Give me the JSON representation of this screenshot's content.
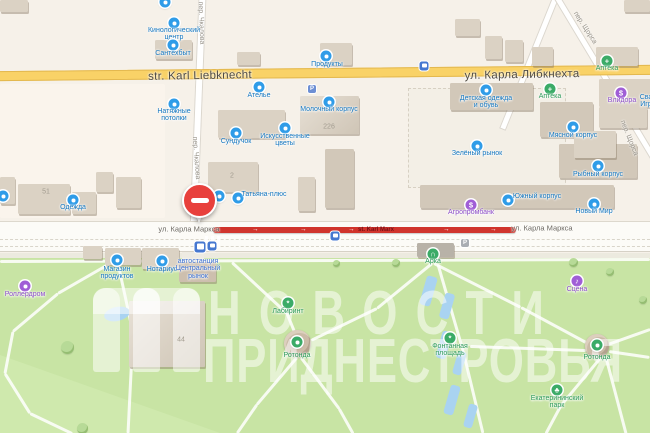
{
  "watermark": {
    "line1": "НОВОСТИ",
    "line2": "ПРИДНЕСТРОВЬЯ"
  },
  "colors": {
    "poi_blue": "#2f9ce8",
    "poi_green": "#3bab67",
    "poi_purple": "#a05ed6",
    "text_blue": "#1477c0",
    "text_green": "#2b9a58",
    "text_purple": "#8d4ec9",
    "text_transit": "#3b6fd1",
    "road_closed": "#d0342c",
    "road_yellow": "#f9d267",
    "park": "#c8e4a4",
    "water": "#a9d3f1"
  },
  "map": {
    "closure": {
      "x1": 213,
      "x2": 516,
      "y_top": 227,
      "label": "st. Karl Marx",
      "label_x": 376,
      "label_y": 230,
      "arrow_glyph": "→",
      "arrows": [
        252,
        300,
        348,
        443,
        490
      ]
    },
    "pin": {
      "x": 199,
      "y": 200,
      "icon": "no-entry-icon"
    },
    "street_labels": [
      {
        "id": "street-karl-liebknecht-en",
        "text": "str. Karl Liebknecht",
        "x": 200,
        "y": 76,
        "rot": -1,
        "cls": "major"
      },
      {
        "id": "street-karla-libknehta-ru",
        "text": "ул. Карла Либкнехта",
        "x": 522,
        "y": 75,
        "rot": -1,
        "cls": "major"
      },
      {
        "id": "street-karla-marksa-left",
        "text": "ул. Карла Маркса",
        "x": 189,
        "y": 229,
        "rot": 0,
        "cls": "minor"
      },
      {
        "id": "street-karla-marksa-right",
        "text": "ул. Карла Маркса",
        "x": 542,
        "y": 228,
        "rot": 0,
        "cls": "minor"
      },
      {
        "id": "street-chkalova-top",
        "text": "пер. Чкалова",
        "x": 201,
        "y": 23,
        "rot": 88,
        "cls": "lane"
      },
      {
        "id": "street-chkalova-mid",
        "text": "пер. Чкалова",
        "x": 196,
        "y": 158,
        "rot": 86,
        "cls": "lane"
      },
      {
        "id": "street-schorsa-top",
        "text": "пер. Щорса",
        "x": 585,
        "y": 28,
        "rot": 57,
        "cls": "lane"
      },
      {
        "id": "street-schorsa-mid",
        "text": "пер. Щорса",
        "x": 629,
        "y": 138,
        "rot": 68,
        "cls": "lane"
      }
    ],
    "numbers": [
      {
        "text": "51",
        "x": 46,
        "y": 192
      },
      {
        "text": "2",
        "x": 232,
        "y": 176
      },
      {
        "text": "226",
        "x": 329,
        "y": 127
      },
      {
        "text": "44",
        "x": 181,
        "y": 340
      }
    ],
    "pois": [
      {
        "id": "poi-kinologichesky-centr",
        "icon": "paw-icon",
        "x": 174,
        "y": 23,
        "c": "blue",
        "glyph": "dot",
        "label": [
          "Кинологический",
          "центр"
        ],
        "lx": 174,
        "ly": 31
      },
      {
        "id": "poi-santehbyt",
        "icon": "shop-icon",
        "x": 173,
        "y": 45,
        "c": "blue",
        "glyph": "dot",
        "label": [
          "Сантехбыт"
        ],
        "lx": 173,
        "ly": 54
      },
      {
        "id": "poi-produkty",
        "icon": "shop-icon",
        "x": 326,
        "y": 56,
        "c": "blue",
        "glyph": "dot",
        "label": [
          "Продукты"
        ],
        "lx": 327,
        "ly": 65
      },
      {
        "id": "poi-atelye",
        "icon": "scissors-icon",
        "x": 259,
        "y": 87,
        "c": "blue",
        "glyph": "dot",
        "label": [
          "Ателье"
        ],
        "lx": 259,
        "ly": 96
      },
      {
        "id": "poi-natyazhnye-potolki",
        "icon": "shop-icon",
        "x": 174,
        "y": 104,
        "c": "blue",
        "glyph": "dot",
        "label": [
          "Натяжные",
          "потолки"
        ],
        "lx": 174,
        "ly": 112
      },
      {
        "id": "poi-molochny-korpus",
        "icon": "market-icon",
        "x": 329,
        "y": 102,
        "c": "blue",
        "glyph": "dot",
        "label": [
          "Молочный корпус"
        ],
        "lx": 329,
        "ly": 110
      },
      {
        "id": "poi-iskusstvennye-tsvety",
        "icon": "flower-icon",
        "x": 285,
        "y": 128,
        "c": "blue",
        "glyph": "dot",
        "label": [
          "Искусственные",
          "цветы"
        ],
        "lx": 285,
        "ly": 137
      },
      {
        "id": "poi-sunduchok",
        "icon": "shop-icon",
        "x": 236,
        "y": 133,
        "c": "blue",
        "glyph": "dot",
        "label": [
          "Сундучок"
        ],
        "lx": 236,
        "ly": 142
      },
      {
        "id": "poi-tatyana-plus",
        "icon": "shop-icon",
        "x": 238,
        "y": 198,
        "c": "blue",
        "glyph": "dot",
        "label": [
          "Татьяна-плюс"
        ],
        "lx": 264,
        "ly": 195
      },
      {
        "id": "poi-shop-near-pin",
        "icon": "shop-icon",
        "x": 219,
        "y": 196,
        "c": "blue",
        "glyph": "dot",
        "label": [],
        "lx": 0,
        "ly": 0
      },
      {
        "id": "poi-odezhda",
        "icon": "clothes-icon",
        "x": 73,
        "y": 200,
        "c": "blue",
        "glyph": "dot",
        "label": [
          "Одежда"
        ],
        "lx": 73,
        "ly": 208
      },
      {
        "id": "poi-left-edge-shop",
        "icon": "shop-icon",
        "x": 3,
        "y": 196,
        "c": "blue",
        "glyph": "dot",
        "label": [],
        "lx": 0,
        "ly": 0
      },
      {
        "id": "poi-top-edge-shop",
        "icon": "shop-icon",
        "x": 165,
        "y": 2,
        "c": "blue",
        "glyph": "dot",
        "label": [],
        "lx": 0,
        "ly": 0
      },
      {
        "id": "poi-detskaya-odezhda",
        "icon": "clothes-icon",
        "x": 486,
        "y": 90,
        "c": "blue",
        "glyph": "dot",
        "label": [
          "Детская одежда",
          "и обувь"
        ],
        "lx": 486,
        "ly": 99
      },
      {
        "id": "poi-apteka-north",
        "icon": "pharmacy-cross-icon",
        "x": 607,
        "y": 61,
        "c": "green",
        "glyph": "+",
        "label": [
          "Аптека"
        ],
        "lx": 607,
        "ly": 69
      },
      {
        "id": "poi-apteka-south",
        "icon": "pharmacy-cross-icon",
        "x": 550,
        "y": 89,
        "c": "green",
        "glyph": "+",
        "label": [
          "Аптека"
        ],
        "lx": 550,
        "ly": 97
      },
      {
        "id": "poi-vlidora",
        "icon": "currency-icon",
        "x": 621,
        "y": 93,
        "c": "purple",
        "glyph": "$",
        "label": [
          "Влидора"
        ],
        "lx": 622,
        "ly": 101
      },
      {
        "id": "poi-edge-partial-label",
        "icon": "",
        "x": 0,
        "y": 0,
        "c": "blue",
        "glyph": "",
        "label": [
          "Сва",
          "Игр"
        ],
        "lx": 646,
        "ly": 98
      },
      {
        "id": "poi-zelyony-rynok",
        "icon": "market-icon",
        "x": 477,
        "y": 146,
        "c": "blue",
        "glyph": "dot",
        "label": [
          "Зелёный рынок"
        ],
        "lx": 477,
        "ly": 154
      },
      {
        "id": "poi-myasnoy-korpus",
        "icon": "market-icon",
        "x": 573,
        "y": 127,
        "c": "blue",
        "glyph": "dot",
        "label": [
          "Мясной корпус"
        ],
        "lx": 573,
        "ly": 136
      },
      {
        "id": "poi-rybny-korpus",
        "icon": "market-icon",
        "x": 598,
        "y": 166,
        "c": "blue",
        "glyph": "dot",
        "label": [
          "Рыбный корпус"
        ],
        "lx": 598,
        "ly": 175
      },
      {
        "id": "poi-yuzhny-korpus",
        "icon": "market-icon",
        "x": 508,
        "y": 200,
        "c": "blue",
        "glyph": "dot",
        "label": [
          "Южный корпус"
        ],
        "lx": 537,
        "ly": 197
      },
      {
        "id": "poi-agroprombank",
        "icon": "bank-icon",
        "x": 471,
        "y": 205,
        "c": "purple",
        "glyph": "$",
        "label": [
          "Агропромбанк"
        ],
        "lx": 471,
        "ly": 213
      },
      {
        "id": "poi-novy-mir",
        "icon": "shop-icon",
        "x": 594,
        "y": 204,
        "c": "blue",
        "glyph": "dot",
        "label": [
          "Новый Мир"
        ],
        "lx": 594,
        "ly": 212
      },
      {
        "id": "poi-magazin-produktov",
        "icon": "shop-icon",
        "x": 117,
        "y": 260,
        "c": "blue",
        "glyph": "dot",
        "label": [
          "Магазин",
          "продуктов"
        ],
        "lx": 117,
        "ly": 270
      },
      {
        "id": "poi-notarius",
        "icon": "notary-icon",
        "x": 162,
        "y": 261,
        "c": "blue",
        "glyph": "dot",
        "label": [
          "Нотариус"
        ],
        "lx": 162,
        "ly": 270
      },
      {
        "id": "poi-avtostantsiya",
        "icon": "",
        "x": 0,
        "y": 0,
        "c": "transit",
        "glyph": "",
        "label": [
          "автостанция",
          "Центральный",
          "рынок"
        ],
        "lx": 198,
        "ly": 262
      },
      {
        "id": "poi-rollerdrom",
        "icon": "skate-icon",
        "x": 25,
        "y": 286,
        "c": "purple",
        "glyph": "dot",
        "label": [
          "Роллердром"
        ],
        "lx": 25,
        "ly": 295
      },
      {
        "id": "poi-arka",
        "icon": "arch-icon",
        "x": 433,
        "y": 254,
        "c": "green",
        "glyph": "∩",
        "label": [
          "Арка"
        ],
        "lx": 433,
        "ly": 262
      },
      {
        "id": "poi-scena",
        "icon": "music-icon",
        "x": 577,
        "y": 281,
        "c": "purple",
        "glyph": "♪",
        "label": [
          "Сцена"
        ],
        "lx": 577,
        "ly": 290
      },
      {
        "id": "poi-labirint",
        "icon": "maze-icon",
        "x": 288,
        "y": 303,
        "c": "green",
        "glyph": "*",
        "label": [
          "Лабиринт"
        ],
        "lx": 288,
        "ly": 312
      },
      {
        "id": "poi-rotonda-1",
        "icon": "landmark-icon",
        "x": 297,
        "y": 342,
        "c": "green",
        "glyph": "dot",
        "label": [
          "Ротонда"
        ],
        "lx": 297,
        "ly": 356
      },
      {
        "id": "poi-fontannaya-ploshchad",
        "icon": "fountain-icon",
        "x": 450,
        "y": 338,
        "c": "green",
        "glyph": "*",
        "label": [
          "Фонтанная",
          "площадь"
        ],
        "lx": 450,
        "ly": 347
      },
      {
        "id": "poi-rotonda-2",
        "icon": "landmark-icon",
        "x": 597,
        "y": 345,
        "c": "green",
        "glyph": "dot",
        "label": [
          "Ротонда"
        ],
        "lx": 597,
        "ly": 358
      },
      {
        "id": "poi-ekaterininsky-park",
        "icon": "tree-icon",
        "x": 557,
        "y": 390,
        "c": "green",
        "glyph": "♣",
        "label": [
          "Екатерининский",
          "парк"
        ],
        "lx": 557,
        "ly": 399
      }
    ],
    "transit_stops": [
      {
        "id": "transit-stop-liebknecht",
        "icon": "bus-icon",
        "x": 424,
        "y": 66,
        "s": 9
      },
      {
        "id": "transit-stop-marx-east",
        "icon": "bus-icon",
        "x": 335,
        "y": 236,
        "s": 9
      },
      {
        "id": "transit-stop-marx-west",
        "icon": "bus-icon",
        "x": 212,
        "y": 246,
        "s": 9
      },
      {
        "id": "transit-bus-station",
        "icon": "bus-station-icon",
        "x": 200,
        "y": 247,
        "s": 11
      }
    ],
    "parkings": [
      {
        "id": "parking-molochny",
        "icon": "parking-icon",
        "x": 312,
        "y": 89,
        "bg": "#6d8fd4",
        "label": "P"
      },
      {
        "id": "parking-marx",
        "icon": "parking-icon",
        "x": 465,
        "y": 243,
        "bg": "#a9adb3",
        "label": "P"
      }
    ],
    "buildings": [
      {
        "id": "bld-top-left",
        "x": 0,
        "y": 0,
        "w": 28,
        "h": 12,
        "s": "a"
      },
      {
        "id": "bld-top-right",
        "x": 624,
        "y": 0,
        "w": 26,
        "h": 12,
        "s": "a"
      },
      {
        "id": "bld-santehbyt",
        "x": 155,
        "y": 40,
        "w": 37,
        "h": 19,
        "s": "a"
      },
      {
        "id": "bld-t1",
        "x": 237,
        "y": 52,
        "w": 23,
        "h": 13,
        "s": "a"
      },
      {
        "id": "bld-produkty",
        "x": 320,
        "y": 43,
        "w": 32,
        "h": 22,
        "s": "a"
      },
      {
        "id": "bld-t2",
        "x": 455,
        "y": 19,
        "w": 25,
        "h": 17,
        "s": "a"
      },
      {
        "id": "bld-t3",
        "x": 485,
        "y": 36,
        "w": 17,
        "h": 23,
        "s": "a"
      },
      {
        "id": "bld-t4",
        "x": 505,
        "y": 40,
        "w": 18,
        "h": 22,
        "s": "a"
      },
      {
        "id": "bld-t5",
        "x": 532,
        "y": 47,
        "w": 21,
        "h": 19,
        "s": "a"
      },
      {
        "id": "bld-apteka",
        "x": 596,
        "y": 47,
        "w": 42,
        "h": 19,
        "s": "a"
      },
      {
        "id": "bld-left-edge",
        "x": 0,
        "y": 177,
        "w": 15,
        "h": 27,
        "s": "a"
      },
      {
        "id": "bld-51",
        "x": 18,
        "y": 184,
        "w": 52,
        "h": 30,
        "s": "a"
      },
      {
        "id": "bld-odezhda",
        "x": 72,
        "y": 192,
        "w": 24,
        "h": 22,
        "s": "a"
      },
      {
        "id": "bld-m1",
        "x": 96,
        "y": 172,
        "w": 17,
        "h": 20,
        "s": "a"
      },
      {
        "id": "bld-m2",
        "x": 116,
        "y": 177,
        "w": 25,
        "h": 31,
        "s": "a"
      },
      {
        "id": "bld-dom2",
        "x": 208,
        "y": 162,
        "w": 50,
        "h": 30,
        "s": "a"
      },
      {
        "id": "bld-sunduchok",
        "x": 218,
        "y": 110,
        "w": 67,
        "h": 28,
        "s": "a"
      },
      {
        "id": "bld-molochny",
        "x": 300,
        "y": 96,
        "w": 59,
        "h": 38,
        "s": "c"
      },
      {
        "id": "bld-m3",
        "x": 298,
        "y": 177,
        "w": 17,
        "h": 34,
        "s": "a"
      },
      {
        "id": "bld-m4",
        "x": 325,
        "y": 149,
        "w": 29,
        "h": 59,
        "s": "b"
      },
      {
        "id": "bld-myasnoy",
        "x": 540,
        "y": 102,
        "w": 53,
        "h": 35,
        "s": "b"
      },
      {
        "id": "bld-rybny",
        "x": 559,
        "y": 144,
        "w": 78,
        "h": 34,
        "s": "b"
      },
      {
        "id": "bld-yuzhny",
        "x": 420,
        "y": 185,
        "w": 194,
        "h": 23,
        "s": "b"
      },
      {
        "id": "bld-detskaya",
        "x": 450,
        "y": 83,
        "w": 83,
        "h": 27,
        "s": "b"
      },
      {
        "id": "bld-vlidora",
        "x": 599,
        "y": 79,
        "w": 54,
        "h": 28,
        "s": "a"
      },
      {
        "id": "bld-r1",
        "x": 599,
        "y": 107,
        "w": 48,
        "h": 21,
        "s": "a"
      },
      {
        "id": "bld-r2",
        "x": 574,
        "y": 131,
        "w": 42,
        "h": 27,
        "s": "a"
      },
      {
        "id": "bld-s1",
        "x": 83,
        "y": 246,
        "w": 19,
        "h": 13,
        "s": "a"
      },
      {
        "id": "bld-s2",
        "x": 105,
        "y": 248,
        "w": 36,
        "h": 17,
        "s": "a"
      },
      {
        "id": "bld-s3",
        "x": 142,
        "y": 248,
        "w": 37,
        "h": 21,
        "s": "a"
      },
      {
        "id": "bld-avtostantsiya",
        "x": 179,
        "y": 262,
        "w": 37,
        "h": 20,
        "s": "brown"
      },
      {
        "id": "bld-arka",
        "x": 417,
        "y": 243,
        "w": 37,
        "h": 14,
        "s": "dark"
      },
      {
        "id": "bld-44",
        "x": 129,
        "y": 301,
        "w": 76,
        "h": 66,
        "s": "c"
      }
    ],
    "paths": [
      [
        110,
        263,
        58,
        293
      ],
      [
        58,
        293,
        13,
        331
      ],
      [
        13,
        331,
        5,
        373
      ],
      [
        5,
        373,
        30,
        413
      ],
      [
        30,
        413,
        72,
        433
      ],
      [
        118,
        263,
        133,
        332
      ],
      [
        133,
        332,
        128,
        433
      ],
      [
        232,
        262,
        287,
        313
      ],
      [
        287,
        313,
        296,
        335
      ],
      [
        297,
        357,
        257,
        404
      ],
      [
        257,
        404,
        237,
        433
      ],
      [
        301,
        357,
        339,
        408
      ],
      [
        339,
        408,
        353,
        433
      ],
      [
        434,
        263,
        521,
        307
      ],
      [
        521,
        307,
        586,
        342
      ],
      [
        432,
        263,
        377,
        308
      ],
      [
        377,
        308,
        311,
        340
      ],
      [
        438,
        264,
        463,
        350
      ],
      [
        463,
        350,
        483,
        433
      ],
      [
        586,
        350,
        470,
        346
      ],
      [
        600,
        358,
        561,
        405
      ],
      [
        561,
        405,
        546,
        433
      ],
      [
        606,
        357,
        626,
        433
      ],
      [
        608,
        344,
        650,
        329
      ],
      [
        609,
        351,
        650,
        357
      ],
      [
        0,
        261,
        650,
        259
      ]
    ],
    "pools": [
      {
        "x": 428,
        "y": 291,
        "w": 11,
        "h": 30,
        "r": 16
      },
      {
        "x": 447,
        "y": 306,
        "w": 10,
        "h": 26,
        "r": 16
      },
      {
        "x": 444,
        "y": 345,
        "w": 10,
        "h": 28,
        "r": 16
      },
      {
        "x": 459,
        "y": 363,
        "w": 9,
        "h": 24,
        "r": 16
      },
      {
        "x": 452,
        "y": 400,
        "w": 10,
        "h": 30,
        "r": 16
      },
      {
        "x": 470,
        "y": 416,
        "w": 9,
        "h": 24,
        "r": 16
      }
    ],
    "pond": {
      "x": 117,
      "y": 314,
      "w": 26,
      "h": 14,
      "r": -12
    },
    "trees": [
      {
        "x": 67,
        "y": 347,
        "d": 13
      },
      {
        "x": 573,
        "y": 262,
        "d": 9
      },
      {
        "x": 610,
        "y": 272,
        "d": 8
      },
      {
        "x": 396,
        "y": 263,
        "d": 8
      },
      {
        "x": 643,
        "y": 300,
        "d": 8
      },
      {
        "x": 82,
        "y": 428,
        "d": 11
      },
      {
        "x": 336,
        "y": 263,
        "d": 7
      }
    ],
    "rotondas": [
      {
        "id": "rotonda-structure-1",
        "x": 297,
        "y": 343,
        "d": 27
      },
      {
        "id": "rotonda-structure-2",
        "x": 597,
        "y": 346,
        "d": 24
      }
    ]
  }
}
